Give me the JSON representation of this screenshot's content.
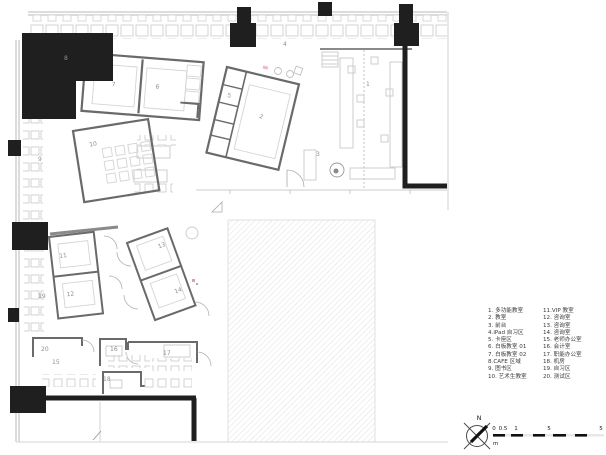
{
  "legend": {
    "items": [
      "1. 多功能教室",
      "2. 教室",
      "3. 前台",
      "4.iPad 自习区",
      "5. 卡座区",
      "6. 白板教室 01",
      "7. 白板教室 02",
      "8.CAFE 区域",
      "9. 图书区",
      "10. 艺术生教室",
      "11.VIP 教室",
      "12. 咨询室",
      "13. 咨询室",
      "14. 咨询室",
      "15. 老师办公室",
      "16. 会计室",
      "17. 职能办公室",
      "18. 机房",
      "19. 自习区",
      "20. 测试区"
    ]
  },
  "plan": {
    "labels": {
      "r1": "1",
      "r2": "2",
      "r3": "3",
      "r4": "4",
      "r5": "5",
      "r6": "6",
      "r7": "7",
      "r8": "8",
      "r9": "9",
      "r10": "10",
      "r11": "11",
      "r12": "12",
      "r13": "13",
      "r14": "14",
      "r15": "15",
      "r16": "16",
      "r17": "17",
      "r18": "18",
      "r19": "19",
      "r20": "20"
    }
  },
  "compass": {
    "north_label": "N"
  },
  "scalebar": {
    "ticks": [
      "0",
      "0.5",
      "1",
      "5",
      "5"
    ],
    "unit": "m"
  },
  "colors": {
    "wall_black": "#1f1f1f",
    "wall_gray": "#6a6a6a",
    "furniture": "#c9c9c9",
    "hatch": "#e2e2e2"
  }
}
